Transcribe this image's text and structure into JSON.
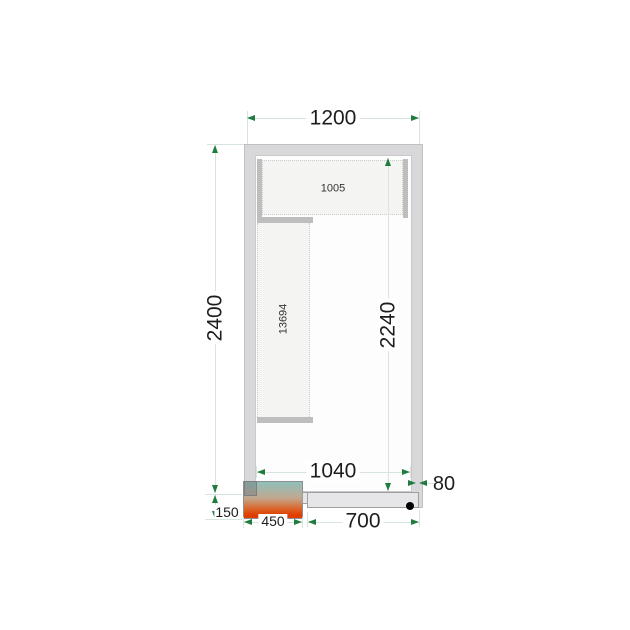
{
  "drawing": {
    "type": "cold-room-floor-plan",
    "labels": {
      "outer_width": "1200",
      "outer_height": "2400",
      "inner_height": "2240",
      "inner_width": "1040",
      "wall_thickness": "80",
      "unit_offset": "150",
      "unit_width": "450",
      "door_width": "700",
      "shelf_top": "1005",
      "shelf_left": "13694"
    }
  },
  "colors": {
    "wall": "#d8d8da",
    "wall_border": "#c0c0c2",
    "interior": "#fdfdfd",
    "interior_border": "#c9c9cb",
    "shelf_fill": "#f4f4f2",
    "shelf_dot": "#cccccc",
    "shelf_bar": "#bebebe",
    "door": "#e6e6e8",
    "door_border": "#9e9ea0",
    "green": "#1f7c3e",
    "pale": "#d8e5dc",
    "ink": "#1d1d1d",
    "unit_top": "#8fc0bc",
    "unit_mid": "#c2a78e",
    "unit_hot": "#dc6326",
    "unit_bottom": "#e03c00"
  }
}
